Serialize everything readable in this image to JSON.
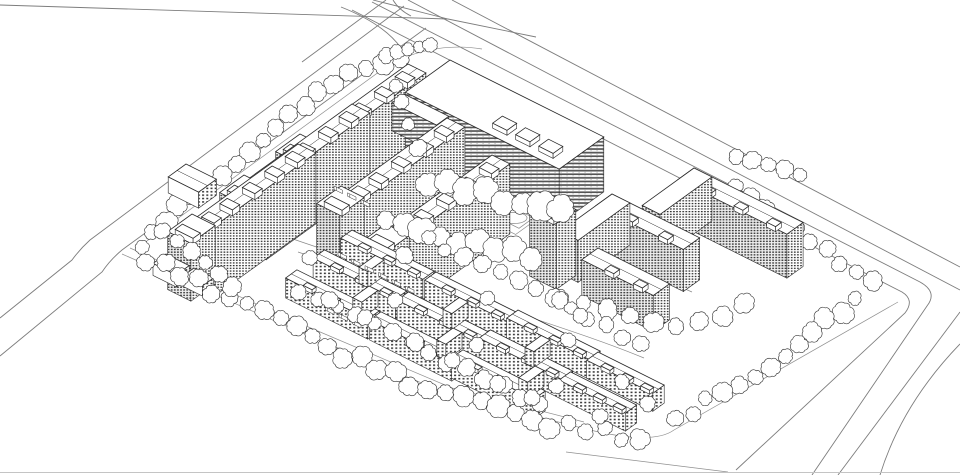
{
  "meta": {
    "type": "axonometric-site-plan",
    "description": "monochrome axonometric architectural drawing of a mixed residential development with high-rise slabs, shopping podium, mid-rise perimeter blocks, low-rise courtyard housing, tree verges and boundary roads"
  },
  "palette": {
    "paper": "#ffffff",
    "ink": "#2a2a2a",
    "ink_light": "#8a8a8a",
    "road": "#7d7d7d",
    "boundary": "#909090",
    "frame": "#c4c4c4",
    "tree": "#3a3a3a",
    "window_dark": "#2d2d2d",
    "stripe_dark": "#555555"
  },
  "roads": [
    {
      "id": "crossing-line",
      "d": "M 0,5 L 448,19 L 536,37"
    },
    {
      "id": "branch-line",
      "d": "M 373,0 L 448,19"
    },
    {
      "id": "branch-fillet-1",
      "d": "M 341,7 Q 384,24 401,48"
    },
    {
      "id": "branch-fillet-2",
      "d": "M 393,0 Q 399,10 411,16"
    },
    {
      "id": "main-road-far",
      "d": "M 452,0 L 960,267"
    },
    {
      "id": "main-road-mid",
      "d": "M 408,0 L 960,290"
    },
    {
      "id": "main-road-outer",
      "d": "M 372,2 L 920,282 Q 938,292 927,306 L 812,475"
    },
    {
      "id": "main-road-near",
      "d": "M 352,10 L 902,292 Q 915,300 905,313 L 736,470"
    },
    {
      "id": "sw-road-far",
      "d": "M 960,312 L 838,475"
    },
    {
      "id": "sw-road-outer",
      "d": "M 960,344 Q 902,404 880,475"
    },
    {
      "id": "nw-road-near",
      "d": "M 426,28 L 122,250 Q 110,260 102,272 L 0,356"
    },
    {
      "id": "nw-road-mid",
      "d": "M 404,6 L 90,240 Q 80,249 72,260 L 0,318"
    },
    {
      "id": "nw-road-far",
      "d": "M 386,0 L 302,62"
    }
  ],
  "boundary": [
    {
      "id": "verge-nw",
      "d": "M 398,58 L 140,246"
    },
    {
      "id": "site-perimeter",
      "d": "M 122,254 L 300,332 L 448,394 L 582,428 Q 652,446 674,430 L 898,302"
    },
    {
      "id": "verge-sw",
      "d": "M 130,248 L 306,326 L 452,388 L 584,422"
    },
    {
      "id": "corner-fillet",
      "d": "M 566,452 L 728,472"
    },
    {
      "id": "corner-arc-n",
      "d": "M 398,60 Q 440,42 482,49"
    }
  ],
  "paths": [
    {
      "id": "internal-road-1",
      "d": "M 322,160 C 362,180 400,198 432,218"
    },
    {
      "id": "internal-road-2",
      "d": "M 290,238 C 360,262 440,288 520,314 C 565,329 605,342 644,358"
    },
    {
      "id": "internal-road-3",
      "d": "M 298,252 C 368,276 448,302 528,328"
    },
    {
      "id": "internal-road-4",
      "d": "M 558,230 C 600,252 646,272 692,292"
    },
    {
      "id": "loop-path",
      "d": "M 392,218 C 420,204 462,204 492,218 C 512,228 508,242 486,250 C 452,262 408,258 388,244 C 376,236 378,226 392,218 Z"
    }
  ],
  "pond": {
    "cx": 514,
    "cy": 218,
    "rx": 13,
    "ry": 5.5
  },
  "court": {
    "o": [
      490,
      194
    ],
    "la": 54,
    "lb": 28,
    "inset_o": [
      496,
      199
    ],
    "inset_la": 42,
    "inset_lb": 18
  },
  "buildings": [
    {
      "id": "slab-nw-1",
      "kind": "highrise-slab",
      "o": [
        408,
        64
      ],
      "la": 20,
      "lb": 128,
      "h": 74,
      "ridge": true,
      "bumps": [
        0.08,
        0.28,
        0.5,
        0.72,
        0.9
      ]
    },
    {
      "id": "tower-nw-1",
      "kind": "tower",
      "o": [
        300,
        134
      ],
      "la": 26,
      "lb": 30,
      "h": 70,
      "bumps": [
        0.5
      ]
    },
    {
      "id": "mall-main",
      "kind": "mall",
      "o": [
        450,
        60
      ],
      "la": 172,
      "lb": 55,
      "h": 55,
      "bumps": [
        0.5,
        0.65,
        0.8
      ]
    },
    {
      "id": "mall-west-wing",
      "kind": "mall",
      "o": [
        404,
        94
      ],
      "la": 50,
      "lb": 15,
      "h": 28
    },
    {
      "id": "slab-nw-2",
      "kind": "highrise-slab",
      "o": [
        352,
        104
      ],
      "la": 20,
      "lb": 128,
      "h": 72,
      "ridge": true,
      "bumps": [
        0.08,
        0.28,
        0.5,
        0.72,
        0.9
      ]
    },
    {
      "id": "tower-nw-2",
      "kind": "tower",
      "o": [
        244,
        175
      ],
      "la": 26,
      "lb": 30,
      "h": 66,
      "bumps": [
        0.5
      ]
    },
    {
      "id": "slab-nw-3",
      "kind": "highrise-slab",
      "o": [
        298,
        144
      ],
      "la": 20,
      "lb": 126,
      "h": 70,
      "ridge": true,
      "bumps": [
        0.08,
        0.28,
        0.5,
        0.72,
        0.9
      ]
    },
    {
      "id": "tower-nw-3",
      "kind": "tower",
      "o": [
        192,
        214
      ],
      "la": 26,
      "lb": 30,
      "h": 58,
      "bumps": [
        0.5
      ]
    },
    {
      "id": "podium-w-1",
      "kind": "podium",
      "o": [
        186,
        164
      ],
      "la": 34,
      "lb": 22,
      "h": 16,
      "ridge": true
    },
    {
      "id": "podium-w-2",
      "kind": "podium",
      "o": [
        166,
        254
      ],
      "la": 26,
      "lb": 16,
      "h": 12
    },
    {
      "id": "podium-w-3",
      "kind": "podium",
      "o": [
        194,
        268
      ],
      "la": 22,
      "lb": 14,
      "h": 10
    },
    {
      "id": "slab-c-1",
      "kind": "highrise-slab",
      "o": [
        447,
        118
      ],
      "la": 20,
      "lb": 126,
      "h": 72,
      "ridge": true,
      "bumps": [
        0.08,
        0.28,
        0.5,
        0.72,
        0.9
      ]
    },
    {
      "id": "tower-c-1",
      "kind": "tower",
      "o": [
        341,
        186
      ],
      "la": 26,
      "lb": 30,
      "h": 64,
      "bumps": [
        0.5
      ]
    },
    {
      "id": "slab-c-2",
      "kind": "highrise-slab",
      "o": [
        492,
        155
      ],
      "la": 20,
      "lb": 126,
      "h": 70,
      "ridge": true,
      "bumps": [
        0.08,
        0.28,
        0.5,
        0.72,
        0.9
      ]
    },
    {
      "id": "tower-c-2",
      "kind": "tower",
      "o": [
        386,
        224
      ],
      "la": 26,
      "lb": 30,
      "h": 60,
      "bumps": [
        0.5
      ]
    },
    {
      "id": "block-e-far-a",
      "kind": "midrise-slab",
      "o": [
        694,
        168
      ],
      "la": 122,
      "lb": 20,
      "h": 44,
      "ridge": true,
      "bumps": [
        0.2,
        0.5,
        0.8
      ]
    },
    {
      "id": "block-e-far-b",
      "kind": "midrise-slab",
      "o": [
        694,
        168
      ],
      "la": 20,
      "lb": 64,
      "h": 44
    },
    {
      "id": "block-e-u-a",
      "kind": "midrise-slab",
      "o": [
        612,
        194
      ],
      "la": 98,
      "lb": 20,
      "h": 42,
      "ridge": true,
      "bumps": [
        0.3,
        0.7
      ]
    },
    {
      "id": "block-e-u-b",
      "kind": "midrise-slab",
      "o": [
        612,
        194
      ],
      "la": 20,
      "lb": 64,
      "h": 42
    },
    {
      "id": "tower-e",
      "kind": "tower",
      "o": [
        549,
        196
      ],
      "la": 30,
      "lb": 24,
      "h": 66,
      "bumps": [
        0.5
      ]
    },
    {
      "id": "slab-e-low",
      "kind": "midrise-slab",
      "o": [
        598,
        248
      ],
      "la": 80,
      "lb": 20,
      "h": 36,
      "ridge": true,
      "bumps": [
        0.3,
        0.7
      ]
    }
  ],
  "clusters": [
    {
      "id": "courtyard-1",
      "o": [
        352,
        230
      ],
      "rows": 3,
      "la": 92,
      "lb": 14,
      "h": 20,
      "gap": 34
    },
    {
      "id": "courtyard-2",
      "o": [
        436,
        272
      ],
      "rows": 3,
      "la": 92,
      "lb": 14,
      "h": 20,
      "gap": 34
    },
    {
      "id": "courtyard-3",
      "o": [
        518,
        310
      ],
      "rows": 3,
      "la": 92,
      "lb": 14,
      "h": 20,
      "gap": 34
    },
    {
      "id": "courtyard-4",
      "o": [
        598,
        352
      ],
      "rows": 2,
      "la": 74,
      "lb": 14,
      "h": 18,
      "gap": 34
    }
  ],
  "trees": {
    "bands_back": [
      {
        "id": "verge-nw-trees",
        "pts": [
          [
            400,
            56
          ],
          [
            330,
            84
          ],
          [
            252,
            148
          ],
          [
            168,
            218
          ],
          [
            140,
            246
          ]
        ],
        "n": 19,
        "r": 8,
        "spread": 5
      },
      {
        "id": "n-corner-trees",
        "pts": [
          [
            386,
            54
          ],
          [
            430,
            46
          ]
        ],
        "n": 5,
        "r": 6,
        "spread": 2
      },
      {
        "id": "e-outer-trees",
        "pts": [
          [
            734,
            188
          ],
          [
            872,
            282
          ]
        ],
        "n": 10,
        "r": 8,
        "spread": 5
      },
      {
        "id": "ne-right-trees",
        "pts": [
          [
            736,
            158
          ],
          [
            800,
            174
          ]
        ],
        "n": 5,
        "r": 7,
        "spread": 3
      }
    ],
    "bands_front": [
      {
        "id": "sw-boundary-trees",
        "pts": [
          [
            148,
            258
          ],
          [
            240,
            302
          ],
          [
            330,
            347
          ],
          [
            430,
            390
          ],
          [
            540,
            422
          ],
          [
            640,
            438
          ]
        ],
        "n": 30,
        "r": 8,
        "spread": 7
      },
      {
        "id": "w-tower-trees",
        "pts": [
          [
            162,
            232
          ],
          [
            232,
            286
          ]
        ],
        "n": 6,
        "r": 7,
        "spread": 4
      },
      {
        "id": "center-large-trees",
        "pts": [
          [
            428,
            180
          ],
          [
            560,
            212
          ]
        ],
        "n": 8,
        "r": 12,
        "spread": 6
      },
      {
        "id": "center-row-trees",
        "pts": [
          [
            385,
            224
          ],
          [
            532,
            256
          ]
        ],
        "n": 9,
        "r": 10,
        "spread": 6
      },
      {
        "id": "right-inner-trees",
        "pts": [
          [
            560,
            298
          ],
          [
            668,
            330
          ],
          [
            745,
            306
          ]
        ],
        "n": 9,
        "r": 8,
        "spread": 5
      },
      {
        "id": "se-corner-trees",
        "pts": [
          [
            856,
            300
          ],
          [
            764,
            368
          ],
          [
            676,
            420
          ]
        ],
        "n": 13,
        "r": 8,
        "spread": 6
      },
      {
        "id": "cluster-ne-trees",
        "pts": [
          [
            428,
            240
          ],
          [
            500,
            274
          ],
          [
            572,
            308
          ],
          [
            640,
            346
          ]
        ],
        "n": 13,
        "r": 7,
        "spread": 4
      },
      {
        "id": "cluster-mid-trees",
        "pts": [
          [
            300,
            290
          ],
          [
            382,
            330
          ],
          [
            462,
            368
          ],
          [
            540,
            404
          ]
        ],
        "n": 14,
        "r": 7,
        "spread": 4
      }
    ],
    "singles": [
      [
        330,
        300,
        8
      ],
      [
        365,
        318,
        7
      ],
      [
        415,
        342,
        8
      ],
      [
        452,
        360,
        7
      ],
      [
        498,
        384,
        8
      ],
      [
        532,
        398,
        7
      ],
      [
        310,
        258,
        7
      ],
      [
        395,
        300,
        7
      ],
      [
        477,
        345,
        7
      ],
      [
        556,
        386,
        7
      ],
      [
        405,
        255,
        8
      ],
      [
        488,
        298,
        7
      ],
      [
        568,
        340,
        7
      ],
      [
        622,
        382,
        7
      ],
      [
        648,
        404,
        7
      ],
      [
        600,
        416,
        7
      ],
      [
        402,
        102,
        7
      ],
      [
        408,
        124,
        6
      ],
      [
        396,
        86,
        6
      ],
      [
        418,
        148,
        8
      ],
      [
        560,
        300,
        8
      ],
      [
        580,
        316,
        7
      ]
    ]
  },
  "cars": {
    "step": [
      13.5,
      6.8
    ],
    "rows": [
      {
        "id": "parking-row-1",
        "start": [
          338,
          252
        ],
        "n": 6
      },
      {
        "id": "parking-row-2",
        "start": [
          312,
          300
        ],
        "n": 4
      },
      {
        "id": "parking-row-3",
        "start": [
          334,
          186
        ],
        "n": 3
      }
    ]
  },
  "frame": {
    "id": "bottom-frame",
    "d": "M 0,472.5 L 960,472.5"
  }
}
